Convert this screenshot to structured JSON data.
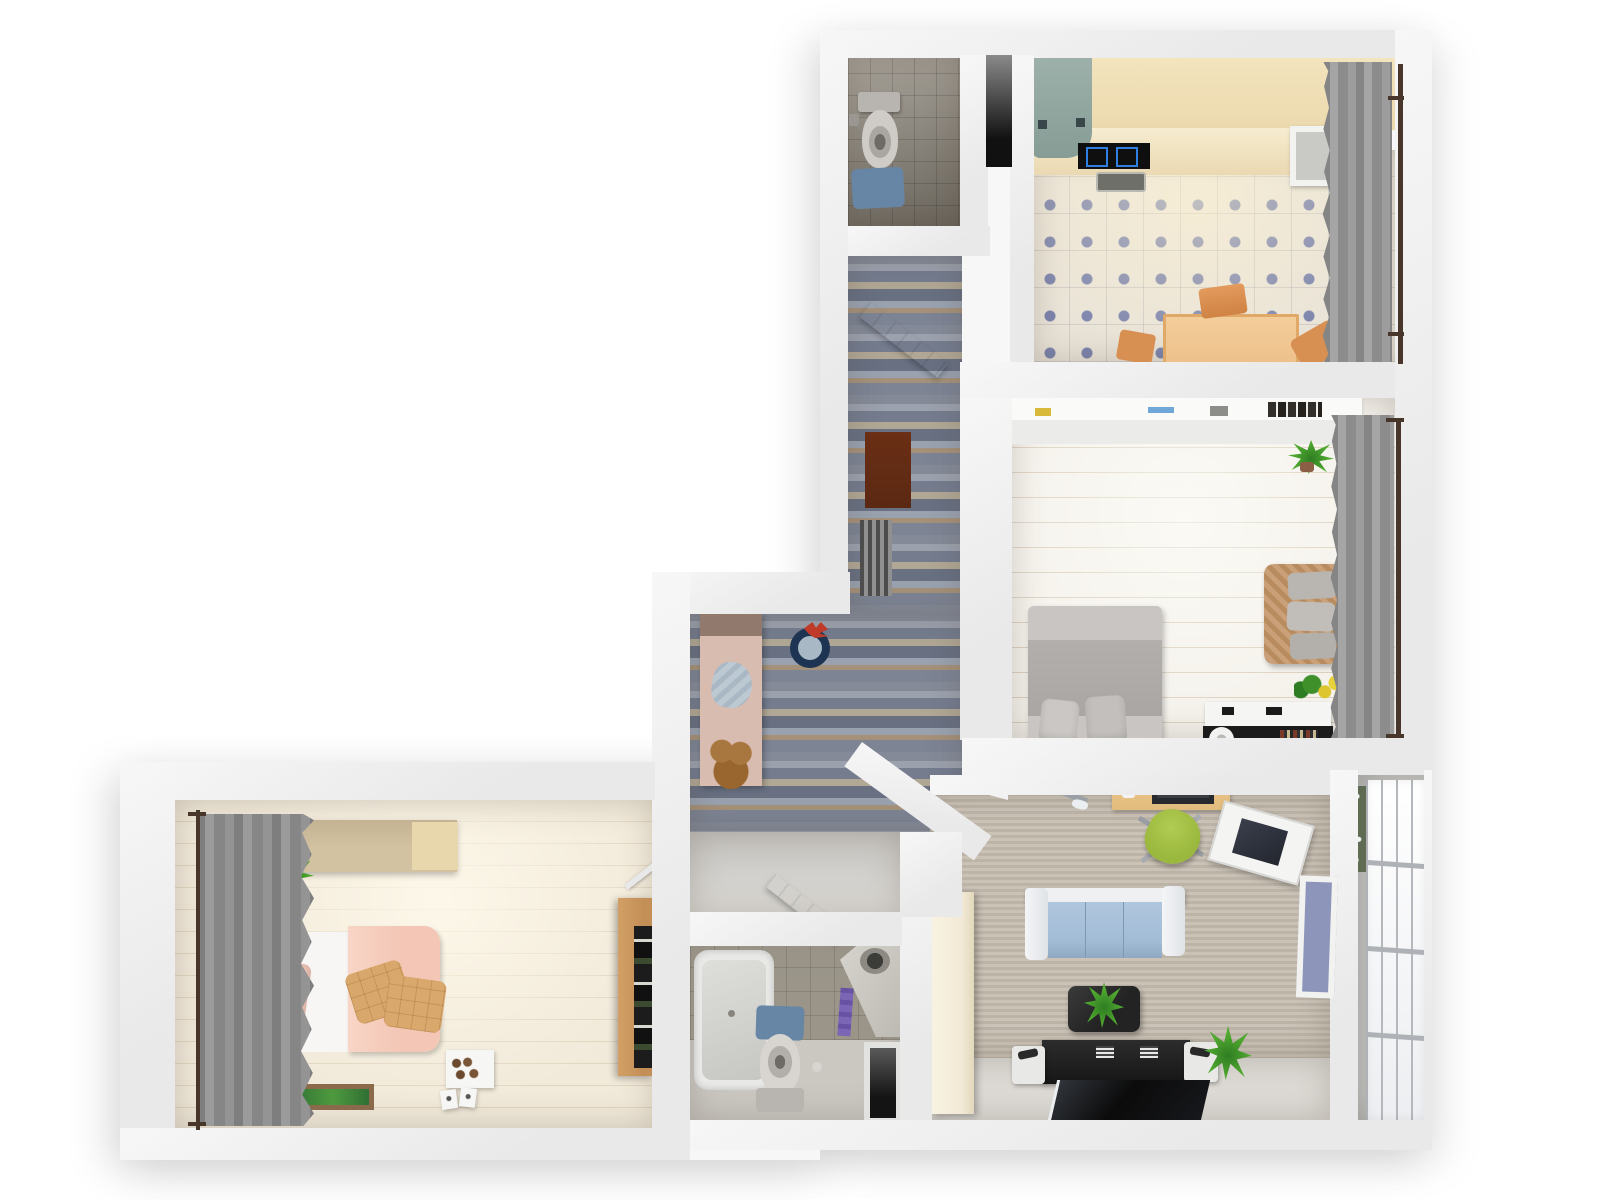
{
  "scene": {
    "type": "3d-floorplan-top-down-render",
    "description": "Photorealistic top-down 3D render of an L-shaped apartment floor plan on a white background. No text is visible in the image.",
    "background": "#ffffff"
  },
  "palette": {
    "bg": "#ffffff",
    "wall": "#e9e9e9",
    "wallLight": "#f7f7f7",
    "wallDark": "#d6d6d6",
    "wcTile": "#8d867a",
    "kitchenTile": "#eae4d8",
    "tileDot": "#7c84ad",
    "woodCounter": "#ecd9ae",
    "tealFridge": "#91a7a0",
    "cooktop": "#0f0f0f",
    "burnerBlue": "#2f7fe0",
    "tableWood": "#eec08a",
    "chairOrange": "#d88f52",
    "plankFloor": "#f5f2ec",
    "plankLine": "#dcd0c0",
    "kidFloor": "#f1e9d9",
    "kidLine": "#e2d5bf",
    "carpet": "#c7beb1",
    "slate": "#8a8f9c",
    "curtainGray": "#949494",
    "rod": "#49362b",
    "bedGray": "#a9a6a3",
    "bedGrayLight": "#c8c5c2",
    "wicker": "#c09468",
    "pillowGray": "#b9b6b2",
    "duvetPink": "#f3c6b5",
    "cushionTan": "#d8a76b",
    "wardrobeBeige": "#d2c2a2",
    "oakWood": "#c48f57",
    "sofaBlue": "#a3bcd6",
    "sofaWhite": "#eef0f2",
    "coffeeBlack": "#232323",
    "tvBlack": "#121212",
    "deskWood": "#e2bc7d",
    "chairGreen": "#9ab83d",
    "bikeGreen": "#56b82a",
    "plantGreen": "#4da32f",
    "creamCab": "#f2ead6",
    "doorMatBrown": "#5b2812",
    "bathMatBlue": "#6786a6",
    "entryPink": "#d9bcb0",
    "clockNavy": "#1d3552",
    "clockRed": "#c03a2a",
    "bathTile": "#938d80",
    "bathFloor": "#cbc8c2",
    "towelPurple": "#7a66b5",
    "balconyFloor": "#c4c4c4",
    "mullion": "#b4b7bc",
    "shaftDark": "#141414",
    "flowerYellow": "#e8d23a"
  },
  "rooms": [
    {
      "id": "wc",
      "label": "WC",
      "floor": "gray ceramic tile",
      "furniture": [
        "toilet with open lid",
        "toilet paper holder",
        "blue bath mat"
      ]
    },
    {
      "id": "kitchen",
      "label": "Kitchen",
      "floor": "cream tile with blue diamond accents",
      "furniture": [
        "wood counter with cooktop and sink",
        "teal refrigerator",
        "open wall shelf",
        "wood dining table",
        "three orange chairs",
        "gray window curtain"
      ]
    },
    {
      "id": "bedroom",
      "label": "Bedroom",
      "floor": "whitewashed plank",
      "furniture": [
        "double bed with gray bedding and pillows",
        "wicker loveseat with gray cushions",
        "long white wall shelf with books",
        "white and black media console with round speaker",
        "potted plant",
        "vase of yellow flowers",
        "gray window curtain"
      ]
    },
    {
      "id": "hallway",
      "label": "Hallway / Entry",
      "floor": "multicolor slate strip tile",
      "furniture": [
        "open white interior door",
        "dark red doormat",
        "wall radiator",
        "pink entry console with light blue towel and teddy bear",
        "navy round wall clock with red bow",
        "open bathroom door"
      ]
    },
    {
      "id": "living-room",
      "label": "Living Room",
      "floor": "taupe carpet",
      "furniture": [
        "blue three-seat sofa with white frame",
        "black coffee table with plant",
        "black media bench with two white speakers",
        "flat black TV panel",
        "wood desk with laptop and phone",
        "green swivel office chair",
        "green bicycle",
        "tilted white wall shelf with screen",
        "cream wardrobe",
        "potted plant",
        "window to balcony"
      ]
    },
    {
      "id": "bathroom",
      "label": "Bathroom",
      "floor": "gray tile",
      "furniture": [
        "bathtub",
        "toilet with blue bath mat",
        "corner vanity with round sink",
        "purple towel",
        "dark utility shaft"
      ]
    },
    {
      "id": "kids-bedroom",
      "label": "Bedroom 2",
      "floor": "light wood plank",
      "furniture": [
        "bed with peach duvet and white headboard",
        "pink pillow",
        "two tan quilted cushions",
        "beige wardrobe",
        "potted plant",
        "gray window curtain",
        "green framed floor mat",
        "white box of chocolates",
        "two greeting cards",
        "oak open wardrobe with dark clothes"
      ]
    },
    {
      "id": "balcony",
      "label": "Balcony",
      "floor": "gray concrete",
      "furniture": [
        "full-height glazed window wall",
        "flower planter"
      ]
    }
  ]
}
